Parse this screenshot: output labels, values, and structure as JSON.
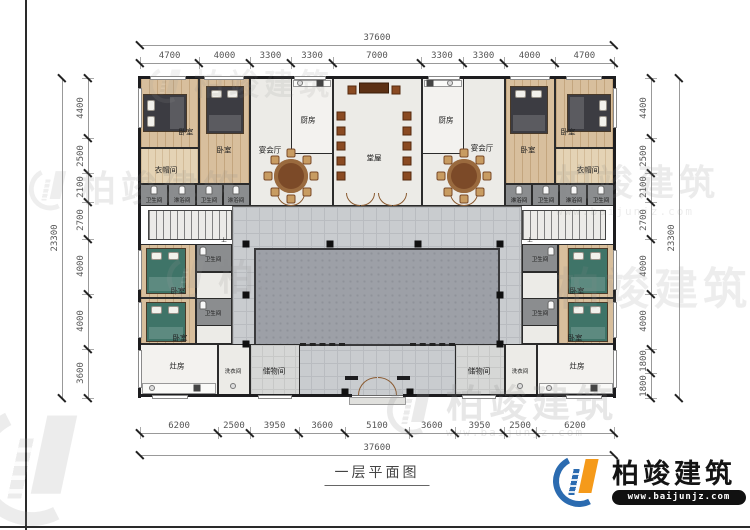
{
  "title": "一层平面图",
  "brand": {
    "name": "柏竣建筑",
    "url": "www.baijunjz.com"
  },
  "watermark": {
    "brand": "柏竣建筑",
    "url": "www.baijunjz.com"
  },
  "dimensions": {
    "top": {
      "total": "37600",
      "segments": [
        "4700",
        "4000",
        "3300",
        "3300",
        "7000",
        "3300",
        "3300",
        "4000",
        "4700"
      ]
    },
    "bottom": {
      "total": "37600",
      "segments": [
        "6200",
        "2500",
        "3950",
        "3600",
        "5100",
        "3600",
        "3950",
        "2500",
        "6200"
      ]
    },
    "left": {
      "total": "23300",
      "segments": [
        "4400",
        "2500",
        "2100",
        "2700",
        "4000",
        "4000",
        "3600"
      ]
    },
    "right": {
      "total": "23300",
      "segments": [
        "4400",
        "2500",
        "2100",
        "2700",
        "4000",
        "4000",
        "1800",
        "1800"
      ]
    }
  },
  "rooms": {
    "bedroom": "卧室",
    "banquet": "宴会厅",
    "kitchen": "厨房",
    "hall": "堂屋",
    "cloakroom": "衣帽间",
    "bathroom": "卫生间",
    "shower": "淋浴间",
    "stove": "灶房",
    "laundry": "洗衣间",
    "storage": "储物间",
    "stairs_up": "上"
  },
  "colors": {
    "wall": "#1d1d1f",
    "wood_floor": "#d8bf9d",
    "hall_floor": "#ecebe7",
    "bath_floor": "#8b8d8f",
    "walkway": "#c9cccf",
    "courtyard": "#9da0a7",
    "logo_blue": "#2b6bb0",
    "logo_orange": "#f59a1a"
  }
}
